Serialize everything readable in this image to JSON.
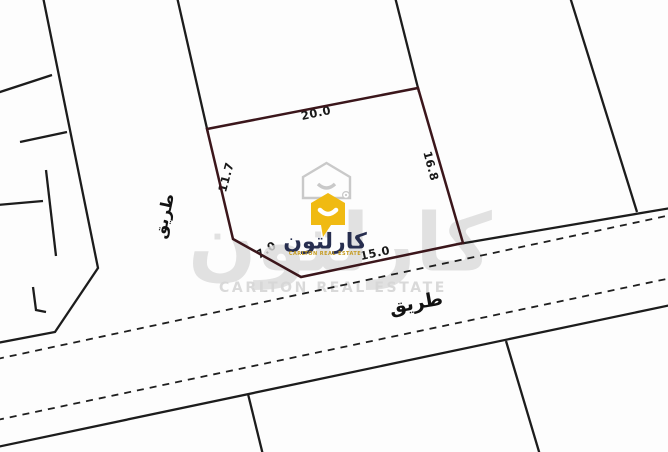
{
  "plot": {
    "dim_top": "20.0",
    "dim_left": "11.7",
    "dim_right": "16.8",
    "dim_bottom": "15.0",
    "dim_corner": "7.0"
  },
  "roads": {
    "vertical_label": "طريق",
    "horizontal_label": "طريق"
  },
  "logo": {
    "name_arabic": "كارلتون",
    "tagline": "CARLTON REAL ESTATE"
  },
  "watermark": {
    "name_arabic": "كارلتون",
    "tagline": "CARLTON REAL ESTATE"
  },
  "colors": {
    "plot_boundary": "#3b161b",
    "parcel_line": "#1c1c1c",
    "logo_yellow": "#f0ba12",
    "logo_navy": "#272e4f",
    "logo_gold": "#c59b20",
    "watermark_gray": "#dbdbdb"
  }
}
